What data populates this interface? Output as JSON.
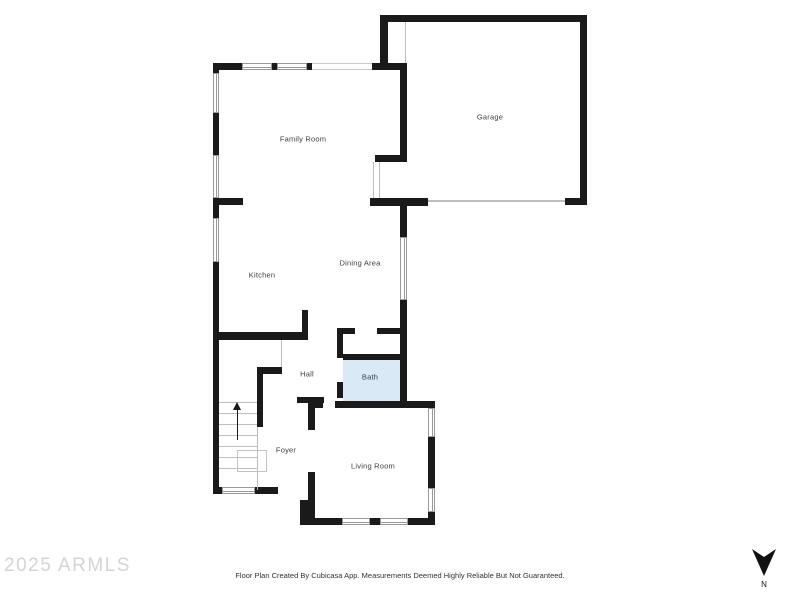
{
  "watermark": "2025 ARMLS",
  "rooms": {
    "family_room": "Family Room",
    "garage": "Garage",
    "kitchen": "Kitchen",
    "dining_area": "Dining Area",
    "hall": "Hall",
    "bath": "Bath",
    "foyer": "Foyer",
    "living_room": "Living Room"
  },
  "footer": {
    "disclaimer": "Floor Plan Created By Cubicasa App. Measurements Deemed Highly Reliable But Not Guaranteed."
  },
  "compass": {
    "label": "N"
  },
  "colors": {
    "wall": "#1a1a1a",
    "bath_fill": "#d9eaf6",
    "window_border": "#9a9a9a",
    "label_text": "#3a4047",
    "watermark_text": "#d4d4d4"
  }
}
